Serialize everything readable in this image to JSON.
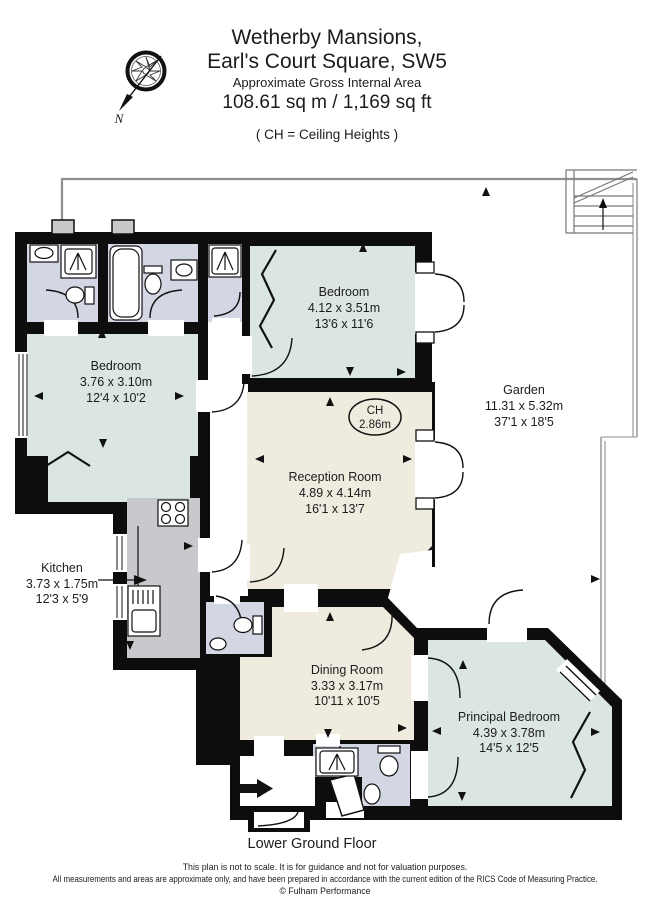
{
  "header": {
    "title_line1": "Wetherby Mansions,",
    "title_line2": "Earl's Court Square, SW5",
    "subtitle": "Approximate Gross Internal Area",
    "area": "108.61 sq m  /  1,169 sq ft",
    "ch_note": "( CH = Ceiling Heights )",
    "compass_n": "N"
  },
  "rooms": {
    "bedroom_left": {
      "name": "Bedroom",
      "metric": "3.76 x 3.10m",
      "imperial": "12'4 x 10'2"
    },
    "bedroom_top": {
      "name": "Bedroom",
      "metric": "4.12 x 3.51m",
      "imperial": "13'6 x 11'6"
    },
    "reception": {
      "name": "Reception Room",
      "metric": "4.89 x 4.14m",
      "imperial": "16'1 x 13'7"
    },
    "garden": {
      "name": "Garden",
      "metric": "11.31 x 5.32m",
      "imperial": "37'1 x 18'5"
    },
    "kitchen": {
      "name": "Kitchen",
      "metric": "3.73 x 1.75m",
      "imperial": "12'3 x 5'9"
    },
    "dining": {
      "name": "Dining Room",
      "metric": "3.33 x 3.17m",
      "imperial": "10'11 x 10'5"
    },
    "principal": {
      "name": "Principal Bedroom",
      "metric": "4.39 x 3.78m",
      "imperial": "14'5 x 12'5"
    }
  },
  "ceiling_height": {
    "label": "CH",
    "value": "2.86m"
  },
  "footer": {
    "floor_label": "Lower Ground Floor",
    "disclaimer_line1": "This plan is not to scale. It is for guidance and not for valuation purposes.",
    "disclaimer_line2": "All measurements and areas are approximate only, and have been prepared in accordance with the current edition of the RICS Code of Measuring Practice.",
    "copyright": "© Fulham Performance"
  },
  "colors": {
    "wall": "#0d0d0d",
    "bedroom_fill": "#dbe6e4",
    "living_fill": "#f0ebdf",
    "bath_fill": "#d2d7e3",
    "kitchen_fill": "#c7c9cc",
    "fence": "#8f8f8f"
  }
}
